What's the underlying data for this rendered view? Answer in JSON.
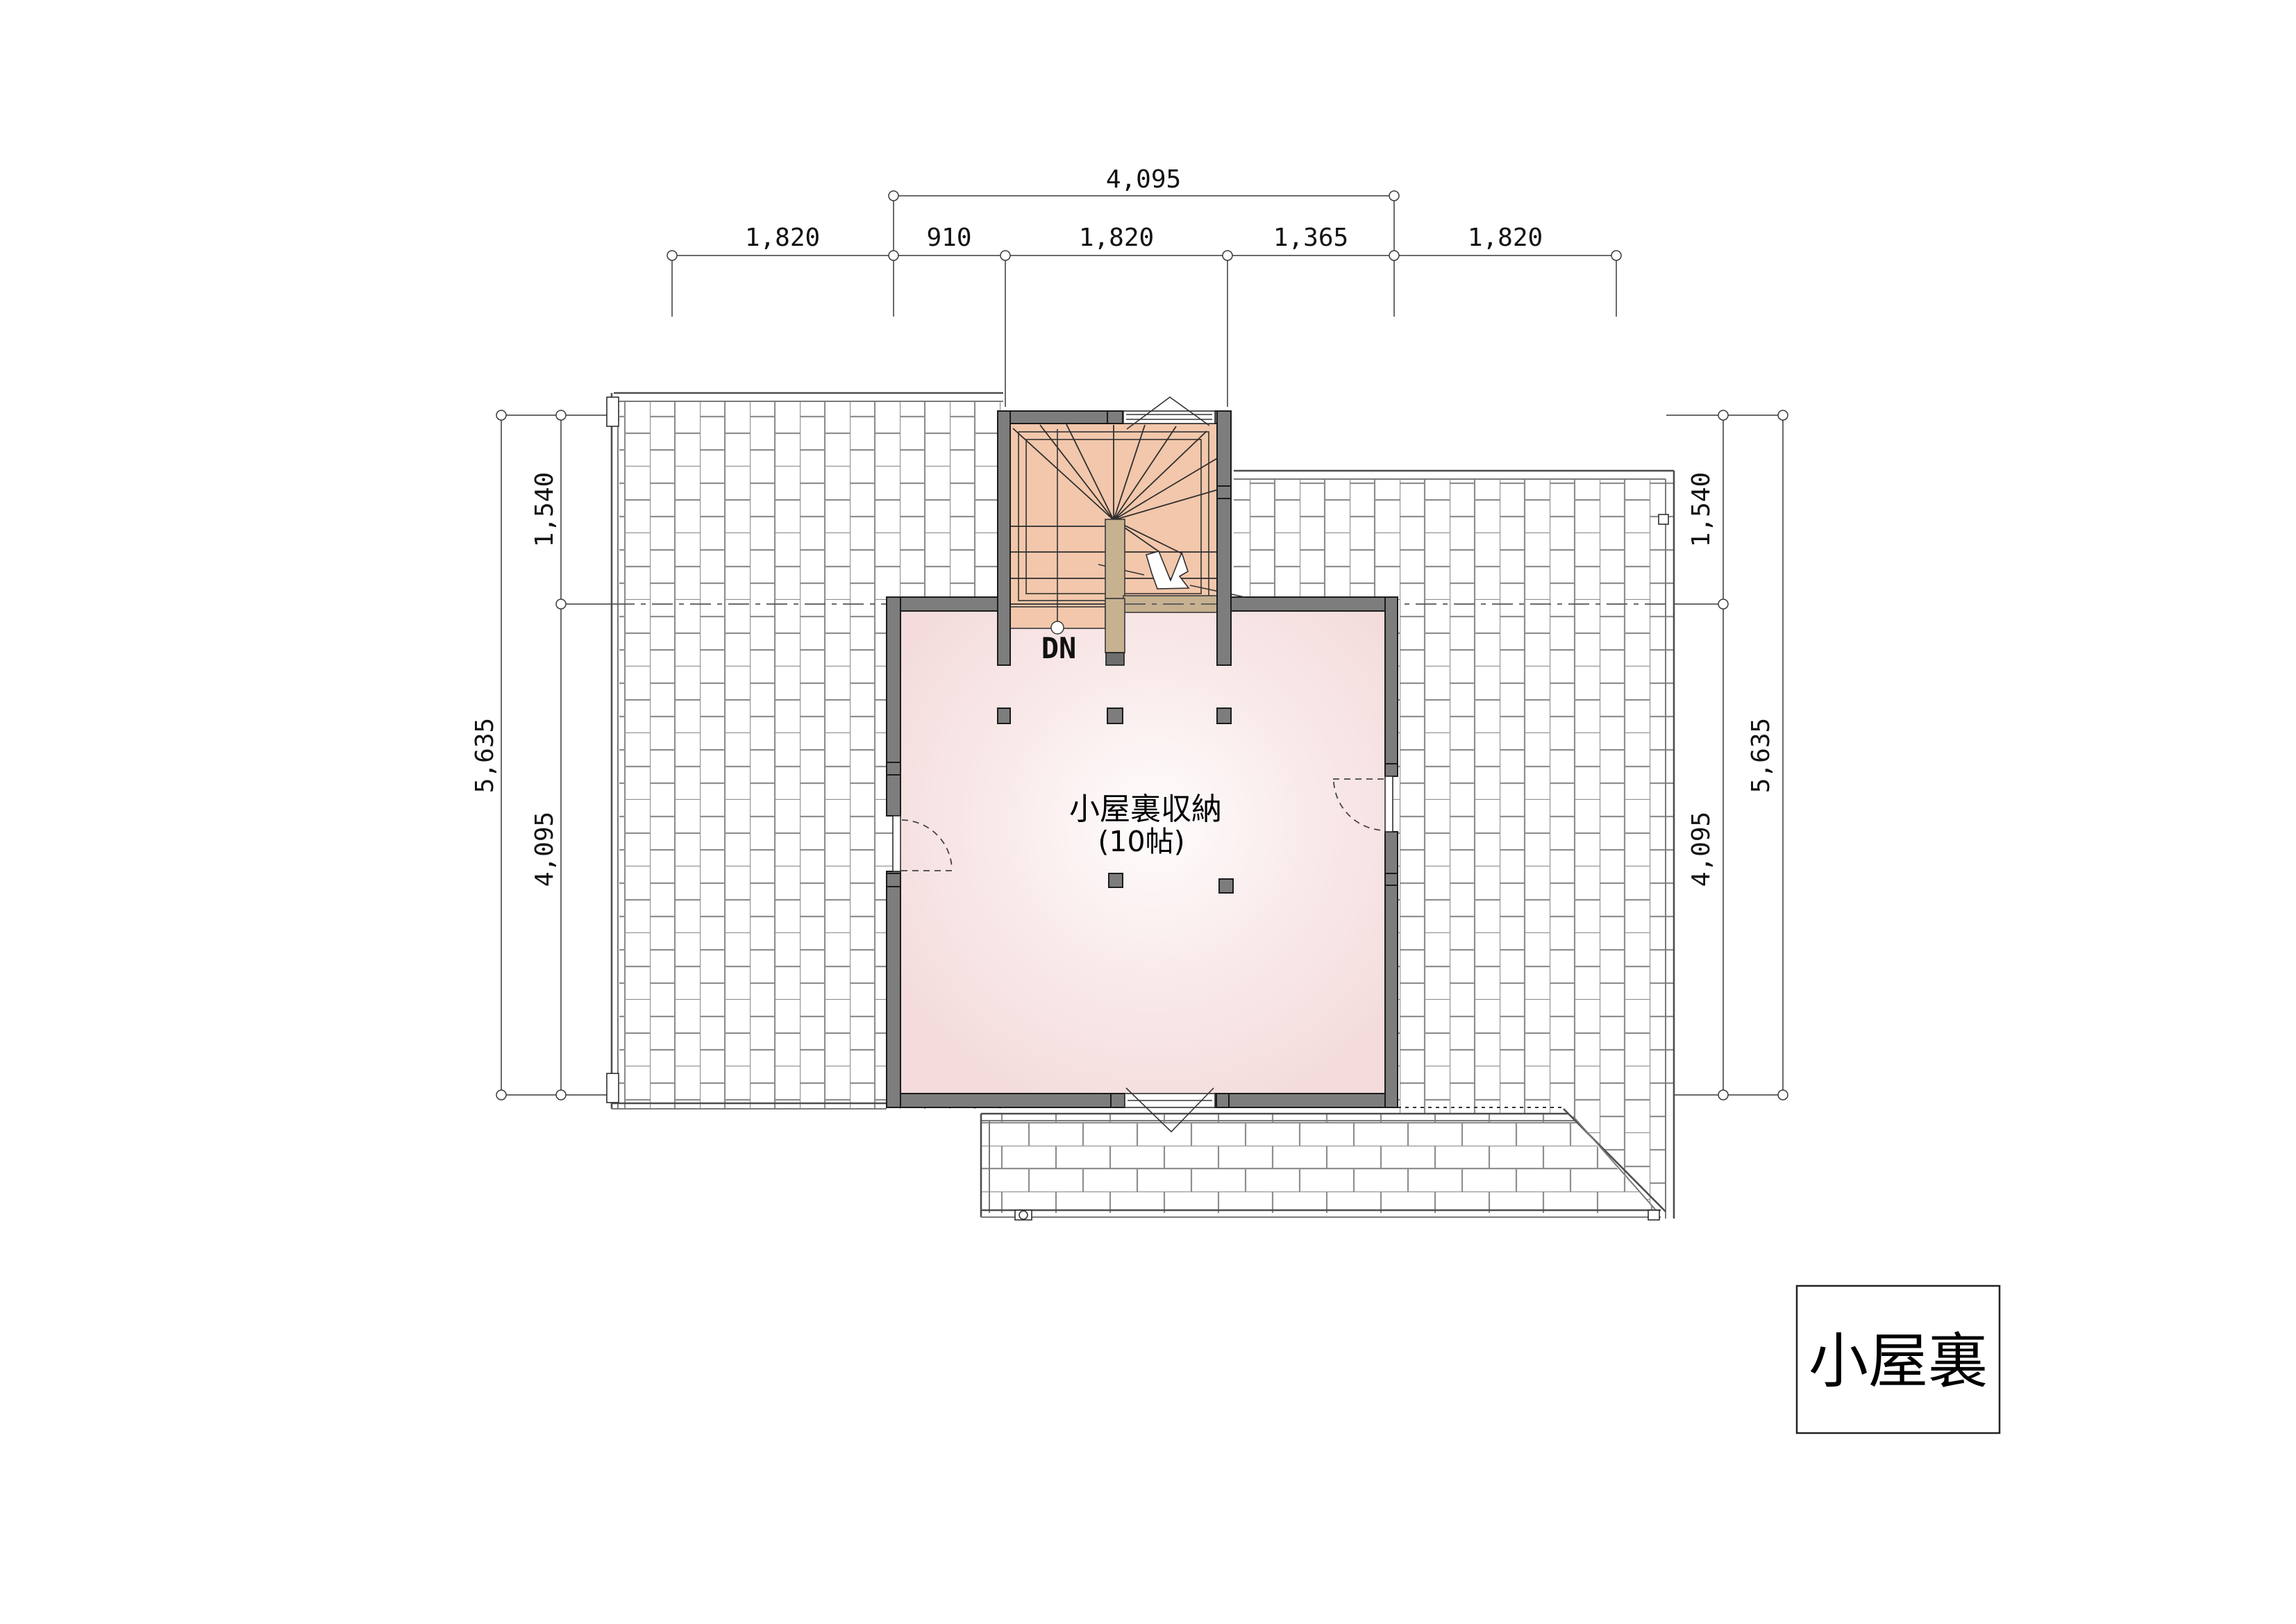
{
  "drawing": {
    "title_block": {
      "label": "小屋裏"
    },
    "room": {
      "name": "小屋裏収納",
      "size": "(10帖)"
    },
    "stair": {
      "down_label": "DN"
    },
    "dimensions": {
      "top_overall": "4,095",
      "top_segments": [
        "1,820",
        "910",
        "1,820",
        "1,365",
        "1,820"
      ],
      "left": {
        "upper": "1,540",
        "lower": "4,095",
        "overall": "5,635"
      },
      "right": {
        "upper": "1,540",
        "lower": "4,095",
        "overall": "5,635"
      }
    },
    "colors": {
      "wall": "#7d7d7d",
      "stair_floor": "#f2c7ab",
      "handrail": "#c6b191",
      "room_fill": "#f6e2e2",
      "hatch_line": "#8f8f8f",
      "line": "#333333"
    }
  }
}
